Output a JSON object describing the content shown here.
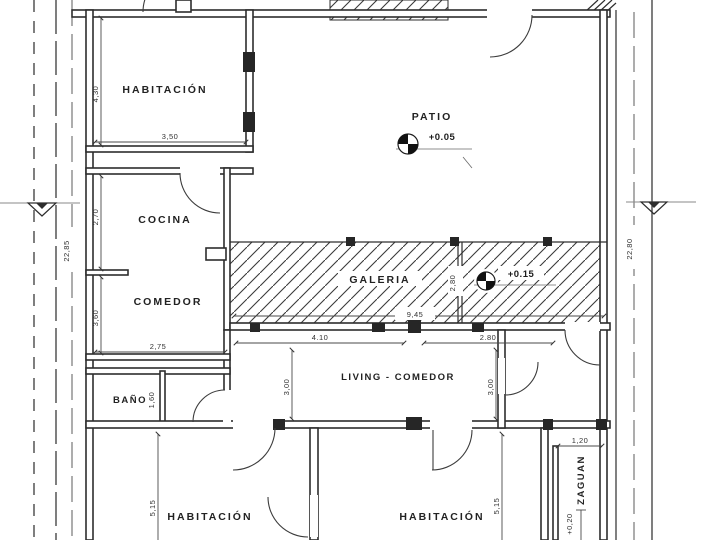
{
  "plan": {
    "colors": {
      "paper": "#ffffff",
      "ink": "#2d2d2d"
    },
    "rooms": {
      "habitacion_top": {
        "label": "HABITACIÓN"
      },
      "patio": {
        "label": "PATIO",
        "elevation": "+0.05"
      },
      "cocina": {
        "label": "COCINA"
      },
      "comedor": {
        "label": "COMEDOR"
      },
      "galeria": {
        "label": "GALERIA",
        "elevation": "+0.15"
      },
      "bano": {
        "label": "BAÑO"
      },
      "living": {
        "label": "LIVING - COMEDOR"
      },
      "habitacion_izq": {
        "label": "HABITACIÓN"
      },
      "habitacion_der": {
        "label": "HABITACIÓN"
      },
      "zaguan": {
        "label": "ZAGUAN",
        "elevation": "+0,20"
      }
    },
    "dimensions": {
      "habitacion_top_ancho": "3,50",
      "habitacion_top_alto": "4,30",
      "cocina_alto": "2,70",
      "comedor_alto": "3,60",
      "comedor_ancho": "2,75",
      "bano_alto": "1,60",
      "galeria_ancho": "9,45",
      "galeria_alto": "2,80",
      "living_ancho_1": "4.10",
      "living_ancho_2": "2.80",
      "living_alto_izq": "3,00",
      "living_alto_der": "3,00",
      "habitacion_izq_alto": "5,15",
      "habitacion_der_alto": "5,15",
      "zaguan_ancho": "1,20",
      "lote_izquierda": "22,85",
      "lote_derecha": "22,80"
    }
  }
}
